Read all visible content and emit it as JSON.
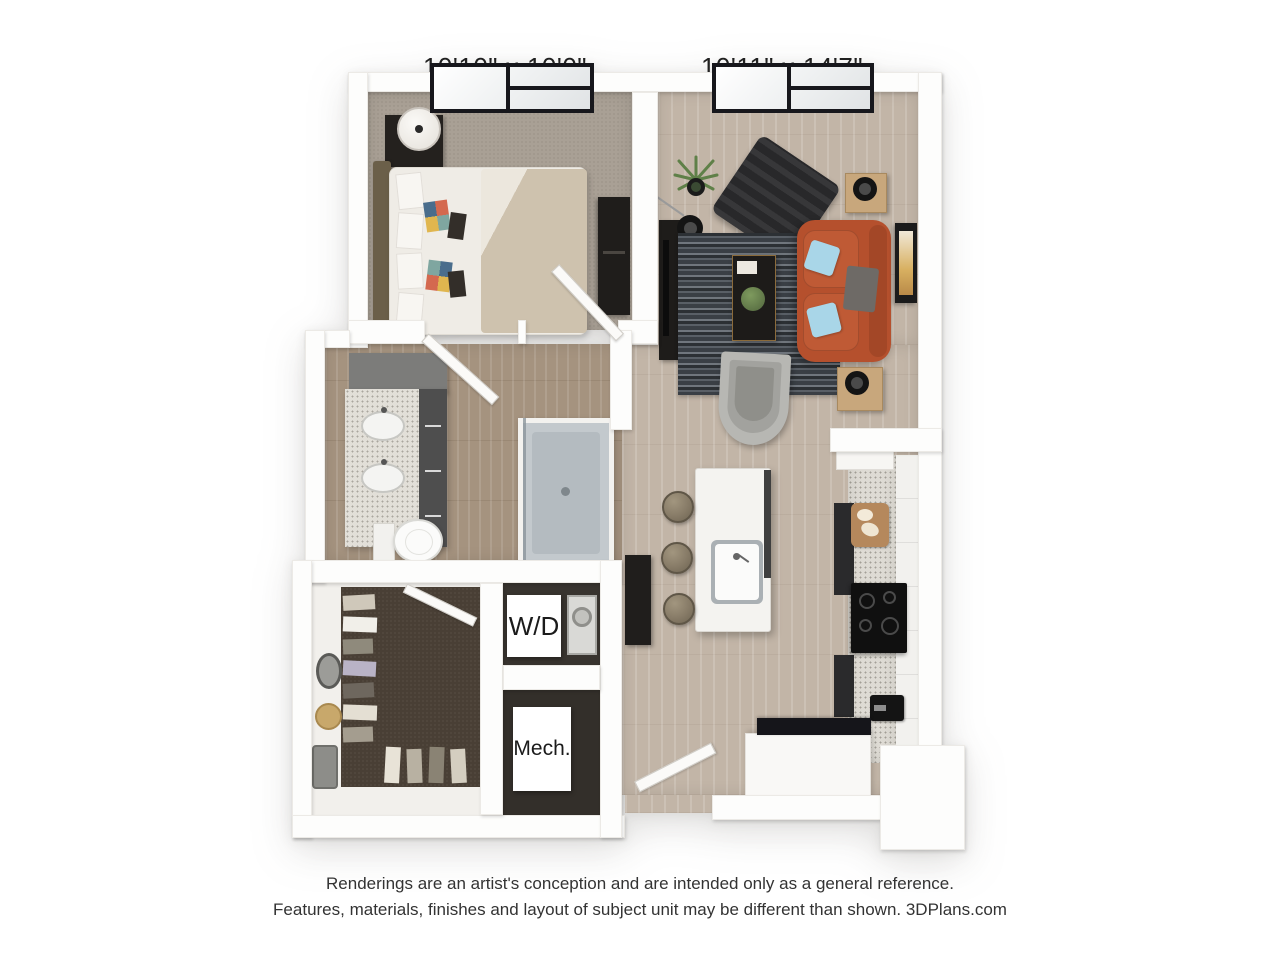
{
  "dimension_labels": {
    "bedroom": "10'10\" x 10'0\"",
    "living_room": "10'11\" x 14'7\""
  },
  "room_labels": {
    "washer_dryer": "W/D",
    "mechanical": "Mech."
  },
  "disclaimer": {
    "line1": "Renderings are an artist's conception and are intended only as a general reference.",
    "line2": "Features, materials, finishes and layout of subject unit may be different than shown. 3DPlans.com"
  },
  "colors": {
    "background": "#ffffff",
    "walls": "#fdfdfc",
    "wood_floor": "#c2b5a7",
    "bathroom_floor": "#a5937f",
    "bedroom_carpet": "#a9a095",
    "closet_carpet": "#493f35",
    "counter_speckle": "#dedbd4",
    "sofa": "#b5502d",
    "sofa_pillow": "#a9d6e8",
    "rug_dark": "#2c3034",
    "window_frame": "#17171c",
    "label_text": "#1f1f1f"
  }
}
